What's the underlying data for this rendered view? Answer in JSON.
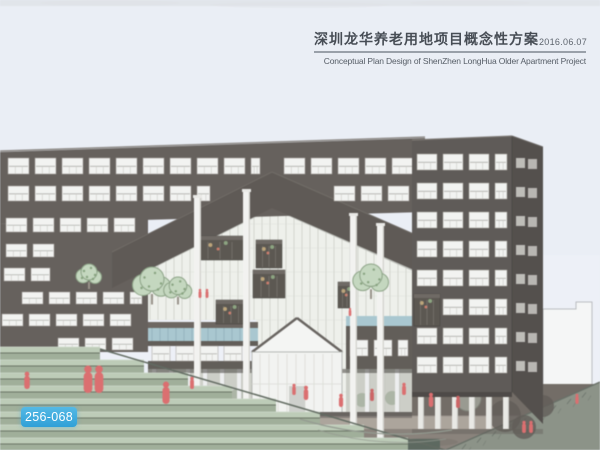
{
  "header": {
    "title_zh": "深圳龙华养老用地项目概念性方案",
    "date": "2016.06.07",
    "subtitle_en": "Conceptual Plan Design of ShenZhen LongHua Older Apartment Project"
  },
  "badge": {
    "label": "256-068",
    "bg": "#3BA9DC",
    "text_color": "#FFFFFF"
  },
  "scene": {
    "description": "Eye-level perspective rendering of a dark brown-grey senior apartment block with a wide chevron roof band over a central glazed atrium, hanging planter balconies, white pilotis and poles, green terraced amphitheater steps, trees, a plaza and red scale figures",
    "colors": {
      "sky": "#E9EDF5",
      "facade": "#534D47",
      "facadeBand": "#4A453F",
      "towerFront": "#4B4641",
      "towerSide": "#3E3A35",
      "windowFill": "#F2F3F0",
      "windowFrame": "#948F88",
      "glass": "#EDEFE9",
      "mullion": "#C7CAC2",
      "podiumBlue": "#9DC2CB",
      "stepTop": "#B4C7AE",
      "stepRiser": "#93A58B",
      "stepLine": "#57624F",
      "treeFill": "#BCD3B4",
      "treeLine": "#7E9A75",
      "plazaDark": "#615A51",
      "walkway": "#A39A8E",
      "groundLow": "#7B7369",
      "embankment": "#7E8677",
      "figureRed": "#E05A5A",
      "pole": "#F2F2EE",
      "boxDark": "#474239",
      "arcade": "#C6C9BF",
      "bgBuilding": "#F5F6F5"
    }
  }
}
